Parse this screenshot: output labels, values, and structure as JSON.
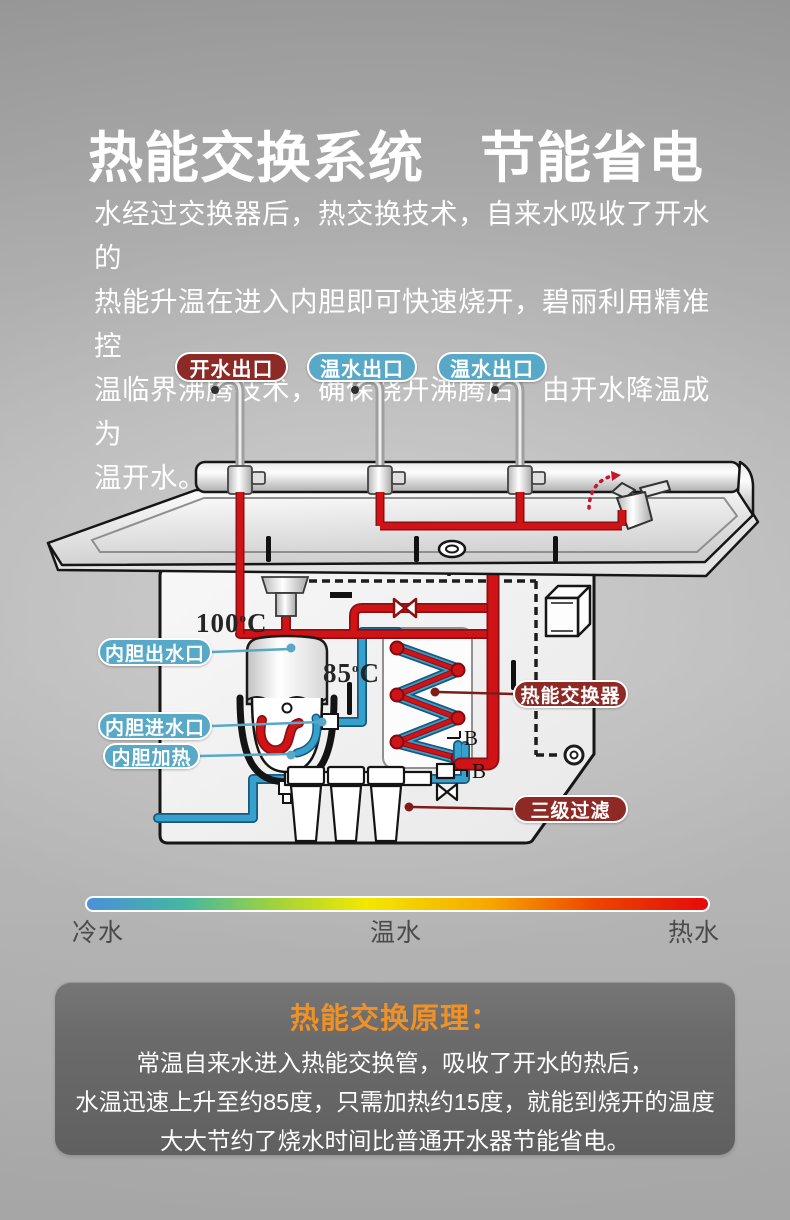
{
  "title": "热能交换系统　节能省电",
  "intro": "水经过交换器后，热交换技术，自来水吸收了开水的\n热能升温在进入内胆即可快速烧开，碧丽利用精准控\n温临界沸腾技术，确保烧开沸腾后，由开水降温成为\n温开水。",
  "diagram": {
    "outlets": [
      {
        "label": "开水出口",
        "type": "hot"
      },
      {
        "label": "温水出口",
        "type": "warm"
      },
      {
        "label": "温水出口",
        "type": "warm"
      }
    ],
    "temp_boiling": {
      "value": "100",
      "degree": "o",
      "unit": "C"
    },
    "temp_warm": {
      "value": "85",
      "degree": "o",
      "unit": "C"
    },
    "labels": {
      "tank_outlet": "内胆出水口",
      "tank_inlet": "内胆进水口",
      "tank_heater": "内胆加热",
      "heat_exchanger": "热能交换器",
      "filter": "三级过滤"
    },
    "connector_mark": "B"
  },
  "legend": {
    "cold": "冷水",
    "warm": "温水",
    "hot": "热水"
  },
  "principle": {
    "title": "热能交换原理：",
    "lines": [
      "常温自来水进入热能交换管，吸收了开水的热后，",
      "水温迅速上升至约85度，只需加热约15度，就能到烧开的温度",
      "大大节约了烧水时间比普通开水器节能省电。"
    ]
  },
  "colors": {
    "hot_pill": "#8e2a26",
    "warm_pill": "#58a8c8",
    "accent_orange": "#ef9126",
    "pipe_hot": "#d01317",
    "pipe_cold": "#35a1cc"
  }
}
